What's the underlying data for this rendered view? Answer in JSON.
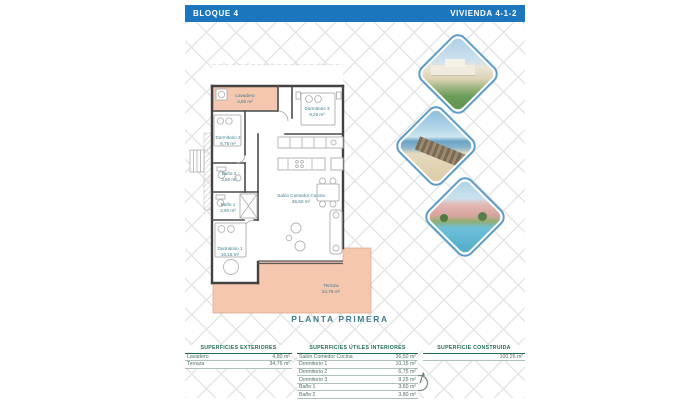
{
  "header": {
    "left": "BLOQUE 4",
    "right": "VIVIENDA 4-1-2"
  },
  "plan": {
    "floor_label": "PLANTA PRIMERA",
    "rooms": {
      "lavadero": {
        "name": "Lavadero",
        "area": "4,80 m²"
      },
      "dormitorio3": {
        "name": "Dormitorio 3",
        "area": "9,25 m²"
      },
      "dormitorio2": {
        "name": "Dormitorio 2",
        "area": "6,75 m²"
      },
      "bano2": {
        "name": "Baño 2",
        "area": "3,80 m²"
      },
      "bano1": {
        "name": "Baño 1",
        "area": "3,60 m²"
      },
      "dormitorio1": {
        "name": "Dormitorio 1",
        "area": "10,15 m²"
      },
      "salon": {
        "name": "Salón Comedor Cocina",
        "area": "36,50 m²"
      },
      "terraza": {
        "name": "Terraza",
        "area": "34,76 m²"
      }
    }
  },
  "photos": [
    {
      "name": "residential-render-photo"
    },
    {
      "name": "beach-boardwalk-photo"
    },
    {
      "name": "resort-pool-photo"
    }
  ],
  "tables": {
    "exteriores": {
      "title": "SUPERFICIES EXTERIORES",
      "rows": [
        {
          "label": "Lavadero",
          "value": "4,80 m²"
        },
        {
          "label": "Terraza",
          "value": "34,76 m²"
        }
      ]
    },
    "interiores": {
      "title": "SUPERFICIES ÚTILES INTERIORES",
      "rows": [
        {
          "label": "Salón Comedor Cocina",
          "value": "36,50 m²"
        },
        {
          "label": "Dormitorio 1",
          "value": "10,15 m²"
        },
        {
          "label": "Dormitorio 2",
          "value": "6,75 m²"
        },
        {
          "label": "Dormitorio 3",
          "value": "9,25 m²"
        },
        {
          "label": "Baño 1",
          "value": "3,60 m²"
        },
        {
          "label": "Baño 2",
          "value": "3,80 m²"
        }
      ]
    },
    "construida": {
      "title": "SUPERFICIE CONSTRUIDA",
      "rows": [
        {
          "label": "",
          "value": "100,26 m²"
        }
      ]
    }
  },
  "colors": {
    "header_blue": "#1b76bd",
    "salmon_fill": "#f4c7ae",
    "label_teal": "#3b7c8f",
    "table_green": "#1f6b58",
    "diamond_border": "#5b9cc9"
  }
}
